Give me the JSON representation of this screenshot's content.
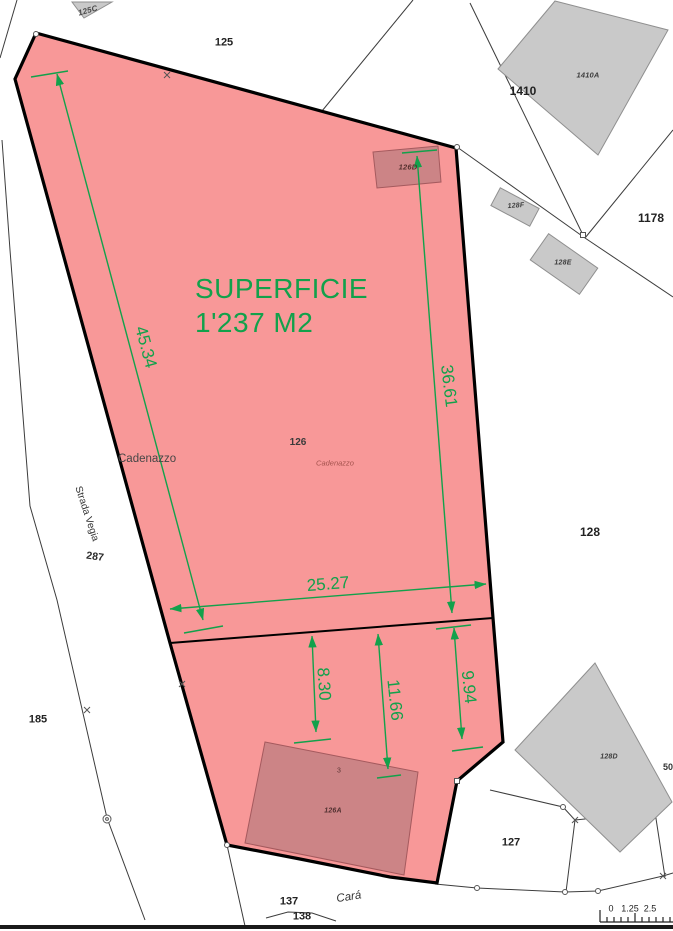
{
  "surface": {
    "line1": "SUPERFICIE",
    "line2": "1'237 M2"
  },
  "dimensions": {
    "d45": "45.34",
    "d36": "36.61",
    "d25": "25.27",
    "d8": "8.30",
    "d11": "11.66",
    "d9": "9.94"
  },
  "parcels": {
    "p125c": "125C",
    "p125": "125",
    "p1410": "1410",
    "p1178": "1178",
    "p128": "128",
    "p185": "185",
    "p287": "287",
    "p127": "127",
    "p137": "137",
    "p138": "138",
    "p126": "126"
  },
  "buildings": {
    "b1410a": "1410A",
    "b126d": "126D",
    "b128f": "128F",
    "b128e": "128E",
    "b128d": "128D",
    "b126a": "126A",
    "b126a_unit": "3",
    "b50": "50"
  },
  "streets": {
    "strada_vegia": "Strada Vegia",
    "cara": "Cará"
  },
  "places": {
    "cadenazzo": "Cadenazzo",
    "cadenazzo_small": "Cadenazzo"
  },
  "scalebar": {
    "zero": "0",
    "mid": "1.25",
    "end": "2.5"
  },
  "colors": {
    "parcel_fill": "#F89898",
    "building_red": "#CC8486",
    "building_gray": "#C9C9C9",
    "dimension_green": "#12A14B",
    "boundary": "#000000"
  }
}
